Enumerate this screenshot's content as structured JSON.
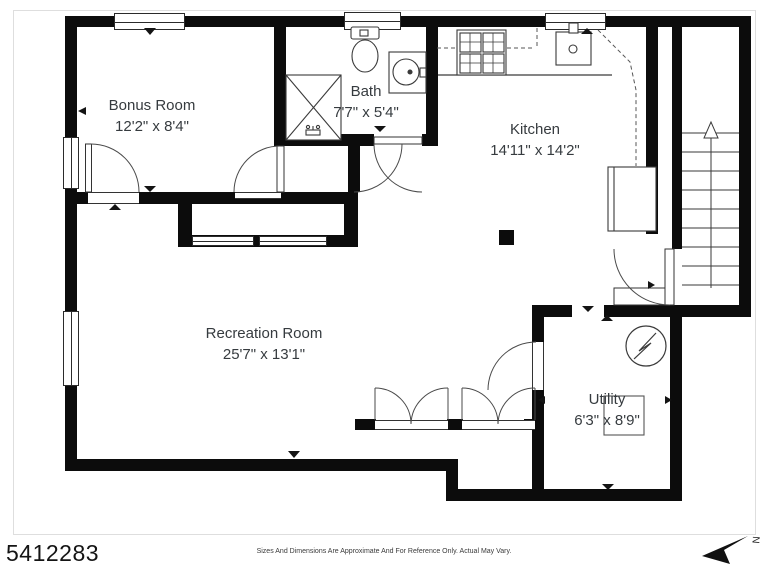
{
  "rooms": {
    "bonus": {
      "name": "Bonus Room",
      "dims": "12'2\" x 8'4\""
    },
    "bath": {
      "name": "Bath",
      "dims": "7'7\" x 5'4\""
    },
    "kitchen": {
      "name": "Kitchen",
      "dims": "14'11\" x 14'2\""
    },
    "recreation": {
      "name": "Recreation Room",
      "dims": "25'7\" x 13'1\""
    },
    "utility": {
      "name": "Utility",
      "dims": "6'3\" x 8'9\""
    }
  },
  "compass": {
    "north_label": "N"
  },
  "stairs": {
    "direction": "up"
  },
  "icons": [
    "shower-icon",
    "toilet-icon",
    "vanity-sink-icon",
    "stove-icon",
    "kitchen-sink-icon",
    "refrigerator-icon",
    "water-heater-icon",
    "utility-appliance-icon",
    "stairs-up-icon",
    "closet-double-doors-icon",
    "north-arrow-icon"
  ],
  "footer": {
    "listing_id": "5412283",
    "disclaimer": "Sizes And Dimensions Are Approximate And For Reference Only. Actual May Vary."
  },
  "colors": {
    "wall": "#0c0c0c",
    "line": "#3a3a3a",
    "text": "#363b3f"
  }
}
